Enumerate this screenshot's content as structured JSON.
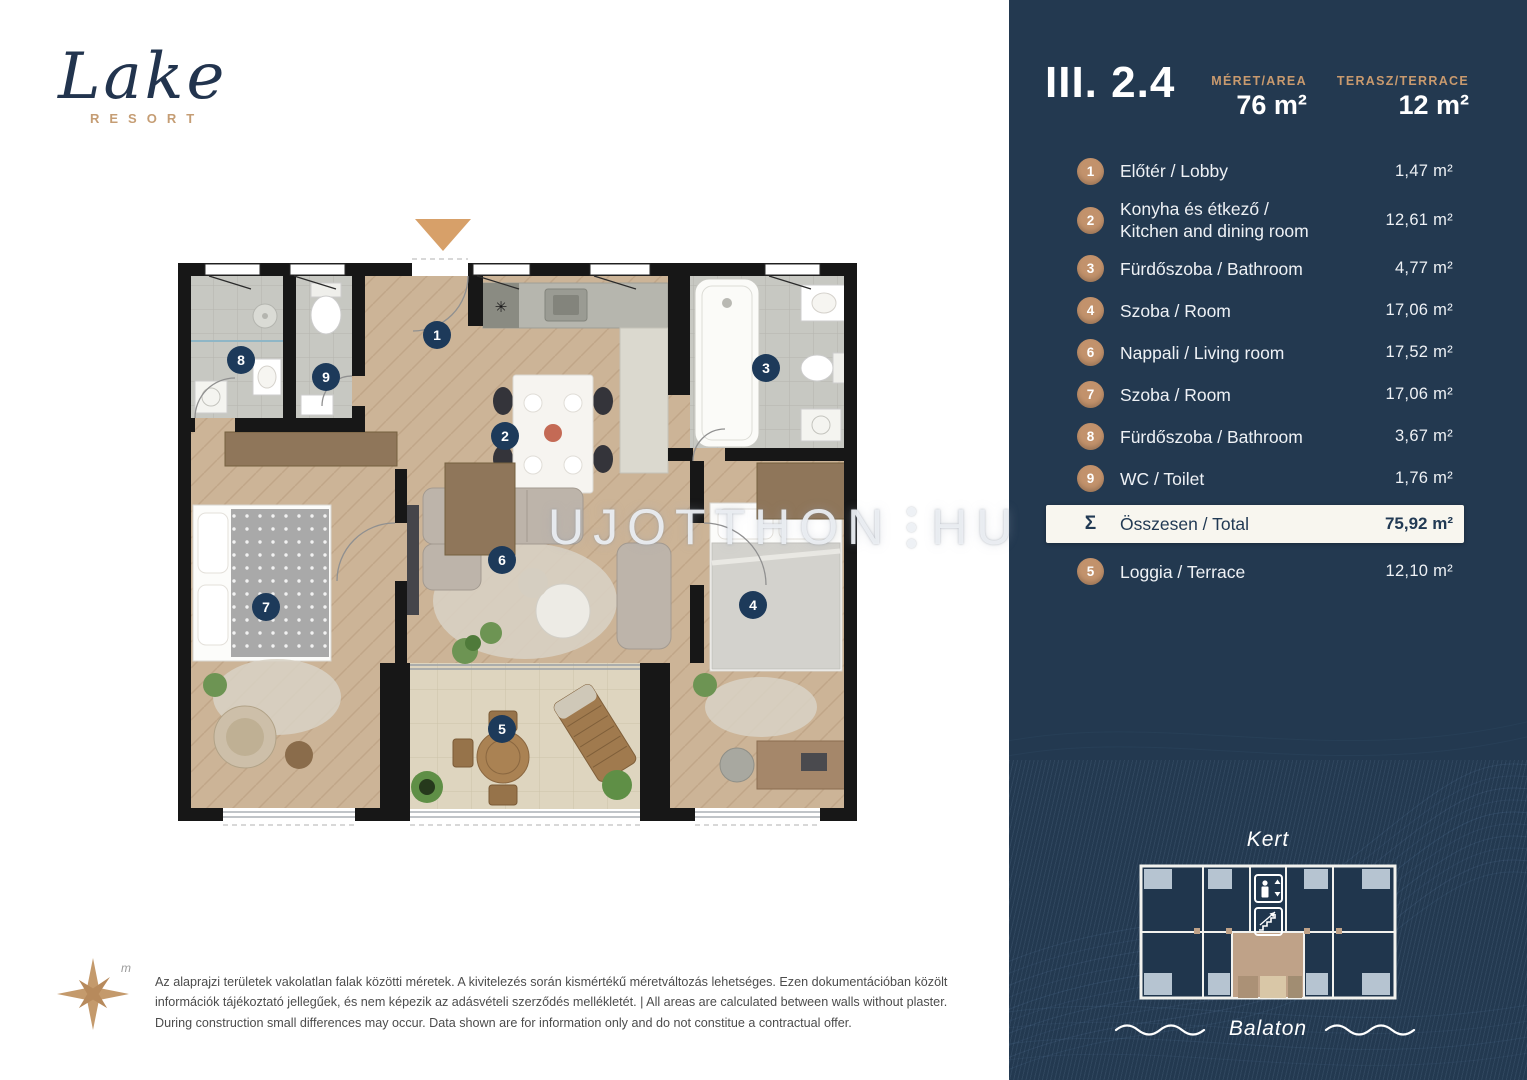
{
  "logo": {
    "title": "Lake",
    "subtitle": "RESORT"
  },
  "panel": {
    "unit": "III. 2.4",
    "area_label": "MÉRET/AREA",
    "area_value": "76 m²",
    "terrace_label": "TERASZ/TERRACE",
    "terrace_value": "12 m²",
    "rooms": [
      {
        "num": "1",
        "line1": "Előtér / Lobby",
        "line2": "",
        "area": "1,47 m²"
      },
      {
        "num": "2",
        "line1": "Konyha  és étkező /",
        "line2": "Kitchen and dining room",
        "area": "12,61 m²"
      },
      {
        "num": "3",
        "line1": "Fürdőszoba / Bathroom",
        "line2": "",
        "area": "4,77 m²"
      },
      {
        "num": "4",
        "line1": "Szoba / Room",
        "line2": "",
        "area": "17,06 m²"
      },
      {
        "num": "6",
        "line1": "Nappali / Living room",
        "line2": "",
        "area": "17,52 m²"
      },
      {
        "num": "7",
        "line1": "Szoba / Room",
        "line2": "",
        "area": "17,06 m²"
      },
      {
        "num": "8",
        "line1": "Fürdőszoba / Bathroom",
        "line2": "",
        "area": "3,67 m²"
      },
      {
        "num": "9",
        "line1": "WC / Toilet",
        "line2": "",
        "area": "1,76 m²"
      }
    ],
    "total": {
      "symbol": "Σ",
      "label": "Összesen / Total",
      "area": "75,92 m²"
    },
    "loggia": {
      "num": "5",
      "label": "Loggia / Terrace",
      "area": "12,10 m²"
    },
    "minimap": {
      "top_label": "Kert",
      "bottom_label": "Balaton"
    }
  },
  "plan": {
    "badges": {
      "b1": "1",
      "b2": "2",
      "b3": "3",
      "b4": "4",
      "b5": "5",
      "b6": "6",
      "b7": "7",
      "b8": "8",
      "b9": "9"
    },
    "kitchen_star": "✳",
    "north_label": "m"
  },
  "watermark": {
    "left": "UJOTTHON",
    "right": "HU"
  },
  "disclaimer": "Az alaprajzi területek vakolatlan falak közötti méretek. A kivitelezés során kismértékű méretváltozás lehetséges. Ezen dokumentációban közölt információk tájékoztató jellegűek, és nem képezik az adásvételi szerződés mellékletét. | All areas are calculated between walls without plaster. During construction small differences may occur. Data shown are for information only and do not constitue a contractual offer.",
  "colors": {
    "panel_navy": "#233950",
    "accent_tan": "#c2926c",
    "badge_navy": "#1d3a5a",
    "total_bar_bg": "#f8f6ef",
    "arrow_tan": "#d7a069"
  }
}
